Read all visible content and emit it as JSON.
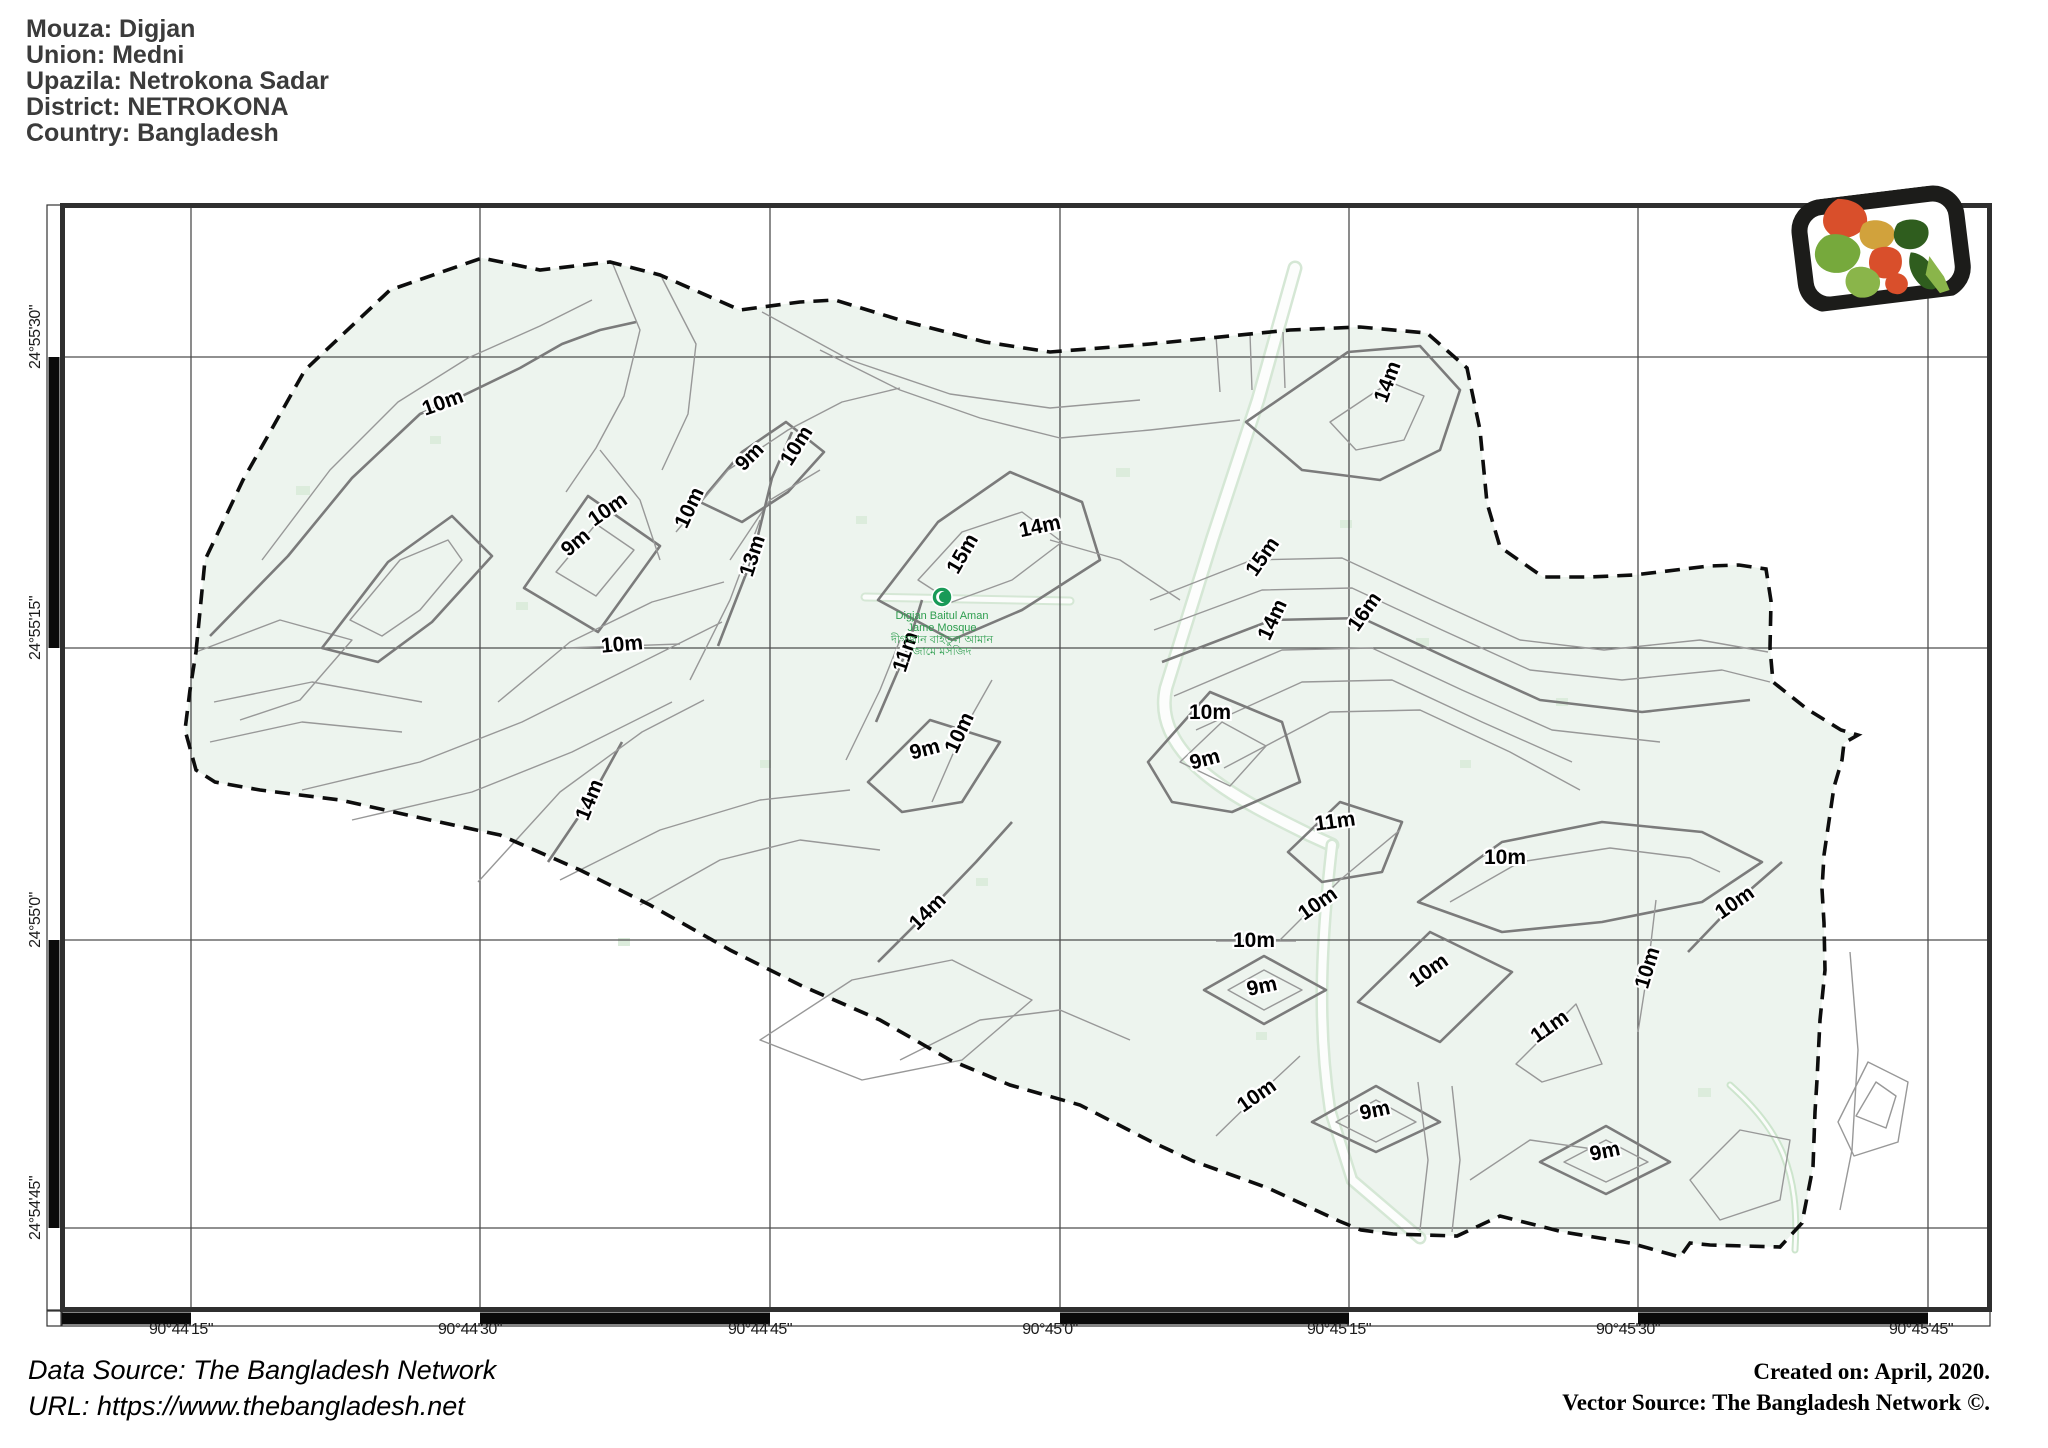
{
  "header": {
    "lines": [
      "Mouza: Digjan",
      "Union: Medni",
      "Upazila: Netrokona Sadar",
      "District: NETROKONA",
      "Country: Bangladesh"
    ]
  },
  "map": {
    "x_axis": {
      "labels": [
        {
          "text": "90°44'15\"",
          "x": 181,
          "y": 1330,
          "rot": 0
        },
        {
          "text": "90°44'30\"",
          "x": 470,
          "y": 1330,
          "rot": 0
        },
        {
          "text": "90°44'45\"",
          "x": 760,
          "y": 1330,
          "rot": 0
        },
        {
          "text": "90°45'0\"",
          "x": 1050,
          "y": 1330,
          "rot": 0
        },
        {
          "text": "90°45'15\"",
          "x": 1339,
          "y": 1330,
          "rot": 0
        },
        {
          "text": "90°45'30\"",
          "x": 1628,
          "y": 1330,
          "rot": 0
        },
        {
          "text": "90°45'45\"",
          "x": 1921,
          "y": 1330,
          "rot": 0
        }
      ]
    },
    "y_axis": {
      "labels": [
        {
          "text": "24°55'30\"",
          "x": 36,
          "y": 337,
          "rot": -90
        },
        {
          "text": "24°55'15\"",
          "x": 36,
          "y": 628,
          "rot": -90
        },
        {
          "text": "24°55'0\"",
          "x": 36,
          "y": 920,
          "rot": -90
        },
        {
          "text": "24°54'45\"",
          "x": 36,
          "y": 1208,
          "rot": -90
        }
      ]
    },
    "contour_labels": [
      {
        "text": "10m",
        "x": 443,
        "y": 403,
        "rot": -20
      },
      {
        "text": "9m",
        "x": 750,
        "y": 457,
        "rot": -45
      },
      {
        "text": "10m",
        "x": 797,
        "y": 446,
        "rot": -58
      },
      {
        "text": "10m",
        "x": 690,
        "y": 508,
        "rot": -65
      },
      {
        "text": "10m",
        "x": 608,
        "y": 510,
        "rot": -35
      },
      {
        "text": "9m",
        "x": 576,
        "y": 543,
        "rot": -40
      },
      {
        "text": "13m",
        "x": 753,
        "y": 556,
        "rot": -72
      },
      {
        "text": "15m",
        "x": 963,
        "y": 554,
        "rot": -60
      },
      {
        "text": "14m",
        "x": 1040,
        "y": 527,
        "rot": -12
      },
      {
        "text": "14m",
        "x": 1388,
        "y": 382,
        "rot": -70
      },
      {
        "text": "15m",
        "x": 1263,
        "y": 557,
        "rot": -55
      },
      {
        "text": "14m",
        "x": 1273,
        "y": 620,
        "rot": -65
      },
      {
        "text": "16m",
        "x": 1365,
        "y": 612,
        "rot": -55
      },
      {
        "text": "10m",
        "x": 622,
        "y": 645,
        "rot": -5
      },
      {
        "text": "11m",
        "x": 906,
        "y": 652,
        "rot": -72
      },
      {
        "text": "10m",
        "x": 960,
        "y": 733,
        "rot": -65
      },
      {
        "text": "9m",
        "x": 925,
        "y": 750,
        "rot": -15
      },
      {
        "text": "10m",
        "x": 1210,
        "y": 713,
        "rot": 0
      },
      {
        "text": "9m",
        "x": 1205,
        "y": 760,
        "rot": -15
      },
      {
        "text": "14m",
        "x": 590,
        "y": 800,
        "rot": -68
      },
      {
        "text": "11m",
        "x": 1335,
        "y": 822,
        "rot": -8
      },
      {
        "text": "10m",
        "x": 1505,
        "y": 858,
        "rot": 0
      },
      {
        "text": "14m",
        "x": 928,
        "y": 912,
        "rot": -45
      },
      {
        "text": "10m",
        "x": 1318,
        "y": 904,
        "rot": -35
      },
      {
        "text": "10m",
        "x": 1254,
        "y": 941,
        "rot": 0
      },
      {
        "text": "10m",
        "x": 1735,
        "y": 903,
        "rot": -35
      },
      {
        "text": "10m",
        "x": 1429,
        "y": 971,
        "rot": -35
      },
      {
        "text": "9m",
        "x": 1262,
        "y": 987,
        "rot": -12
      },
      {
        "text": "11m",
        "x": 1550,
        "y": 1027,
        "rot": -35
      },
      {
        "text": "10m",
        "x": 1648,
        "y": 968,
        "rot": -73
      },
      {
        "text": "10m",
        "x": 1257,
        "y": 1096,
        "rot": -35
      },
      {
        "text": "9m",
        "x": 1375,
        "y": 1111,
        "rot": -12
      },
      {
        "text": "9m",
        "x": 1605,
        "y": 1152,
        "rot": -12
      }
    ],
    "poi": {
      "lines": [
        "Digjan Baitul Aman",
        "Jame Mosque",
        "দীগজান বাইতুল আমান",
        "জামে মসজিদ"
      ]
    },
    "colors": {
      "land": "#edf4ee",
      "contour": "#989898",
      "index_contour": "#7b7b7b",
      "boundary": "#0d0d0d",
      "grid": "#4d4d4d",
      "poi_green": "#2e9e4f"
    }
  },
  "footer": {
    "left_lines": [
      "Data Source: The Bangladesh Network",
      "URL: https://www.thebangladesh.net"
    ],
    "right_lines": [
      "Created on: April, 2020.",
      "Vector Source: The Bangladesh Network ©."
    ]
  },
  "logo": {
    "name": "bangladesh-network-logo",
    "frame_color": "#1c1c1a",
    "region_colors": [
      "#d94f2b",
      "#76a93c",
      "#2f5d1e",
      "#d1a23c",
      "#8ab54a"
    ]
  }
}
